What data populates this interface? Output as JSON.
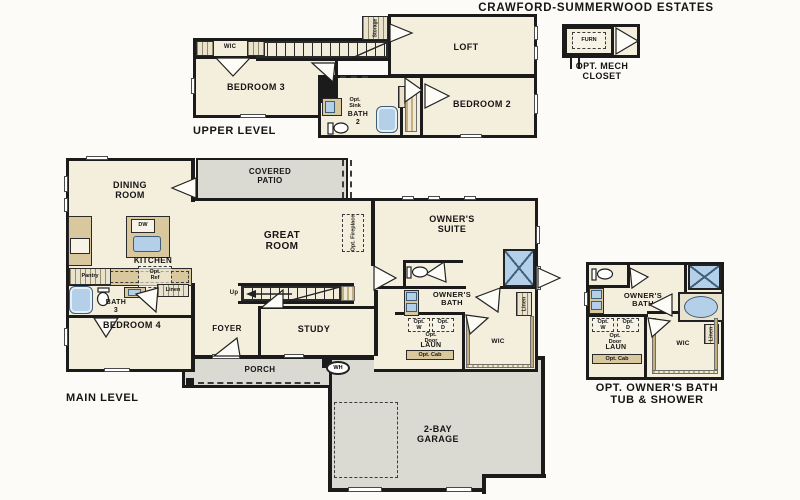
{
  "title": "CRAWFORD-SUMMERWOOD ESTATES",
  "colors": {
    "room_fill": "#f4eedc",
    "outdoor_fill": "#dadad2",
    "wall": "#1b1b1b",
    "fixture_blue": "#b4d0e8",
    "cabinet_tan": "#d9c79e"
  },
  "upper": {
    "caption": "UPPER LEVEL",
    "wic": "WIC",
    "bedroom3": "BEDROOM 3",
    "loft": "LOFT",
    "storage": "Storage",
    "opt_sink": "Opt.\nSink",
    "bath2": "BATH\n2",
    "linen": "Linen",
    "bedroom2": "BEDROOM 2"
  },
  "mech": {
    "furn": "FURN",
    "caption": "OPT. MECH\nCLOSET"
  },
  "main": {
    "caption": "MAIN LEVEL",
    "dining": "DINING\nROOM",
    "covered_patio": "COVERED\nPATIO",
    "kitchen": "KITCHEN",
    "dw": "DW",
    "pantry": "Pantry",
    "opt_ref": "Opt.\nRef",
    "great_room": "GREAT\nROOM",
    "opt_fireplace": "Opt. Fireplace",
    "owners_suite": "OWNER'S\nSUITE",
    "owners_bath": "OWNER'S\nBATH",
    "linen_bath": "Linen",
    "bath3": "BATH\n3",
    "linen_hall": "Linen",
    "bedroom4": "BEDROOM 4",
    "foyer": "FOYER",
    "study": "STUDY",
    "up": "Up",
    "opt_w": "Opt.\nW",
    "opt_d": "Opt.\nD",
    "opt_door": "Opt.\nDoor",
    "laun": "LAUN",
    "opt_cab": "Opt. Cab",
    "wic": "WIC",
    "porch": "PORCH",
    "wh": "WH",
    "garage": "2-BAY\nGARAGE"
  },
  "inset": {
    "owners_bath": "OWNER'S\nBATH",
    "opt_w": "Opt.\nW",
    "opt_d": "Opt.\nD",
    "opt_door": "Opt.\nDoor",
    "laun": "LAUN",
    "opt_cab": "Opt. Cab",
    "wic": "WIC",
    "linen": "Linen",
    "caption": "OPT. OWNER'S BATH\nTUB & SHOWER"
  }
}
